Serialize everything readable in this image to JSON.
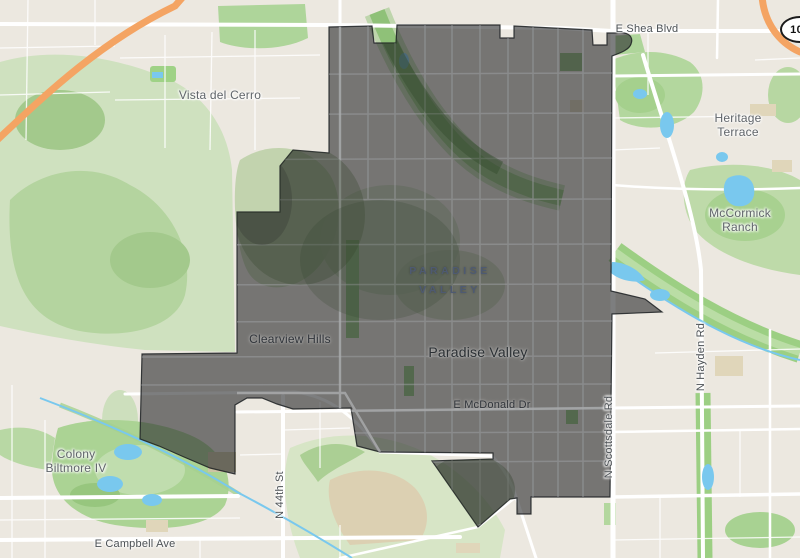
{
  "map": {
    "labels": {
      "shea_blvd": "E Shea Blvd",
      "route_shield": "101",
      "vista_del_cerro": "Vista del Cerro",
      "heritage_line1": "Heritage",
      "heritage_line2": "Terrace",
      "mccormick_line1": "McCormick",
      "mccormick_line2": "Ranch",
      "preserve_line1": "PARADISE",
      "preserve_line2": "VALLEY",
      "clearview_hills": "Clearview Hills",
      "paradise_valley_town": "Paradise Valley",
      "mcdonald_dr": "E McDonald Dr",
      "scottsdale_rd": "N Scottsdale Rd",
      "hayden_rd": "N Hayden Rd",
      "st_44": "N 44th St",
      "colony_line1": "Colony",
      "colony_line2": "Biltmore IV",
      "campbell_ave": "E Campbell Ave"
    },
    "colors": {
      "land": "#ece8e0",
      "terrain_green": "#cfe1bf",
      "park_green": "#aed59a",
      "water": "#79c8ee",
      "road": "#ffffff",
      "highway_orange": "#f4a463",
      "overlay_fill": "rgba(45,47,48,0.62)",
      "overlay_stroke": "rgba(28,32,34,0.85)"
    }
  }
}
